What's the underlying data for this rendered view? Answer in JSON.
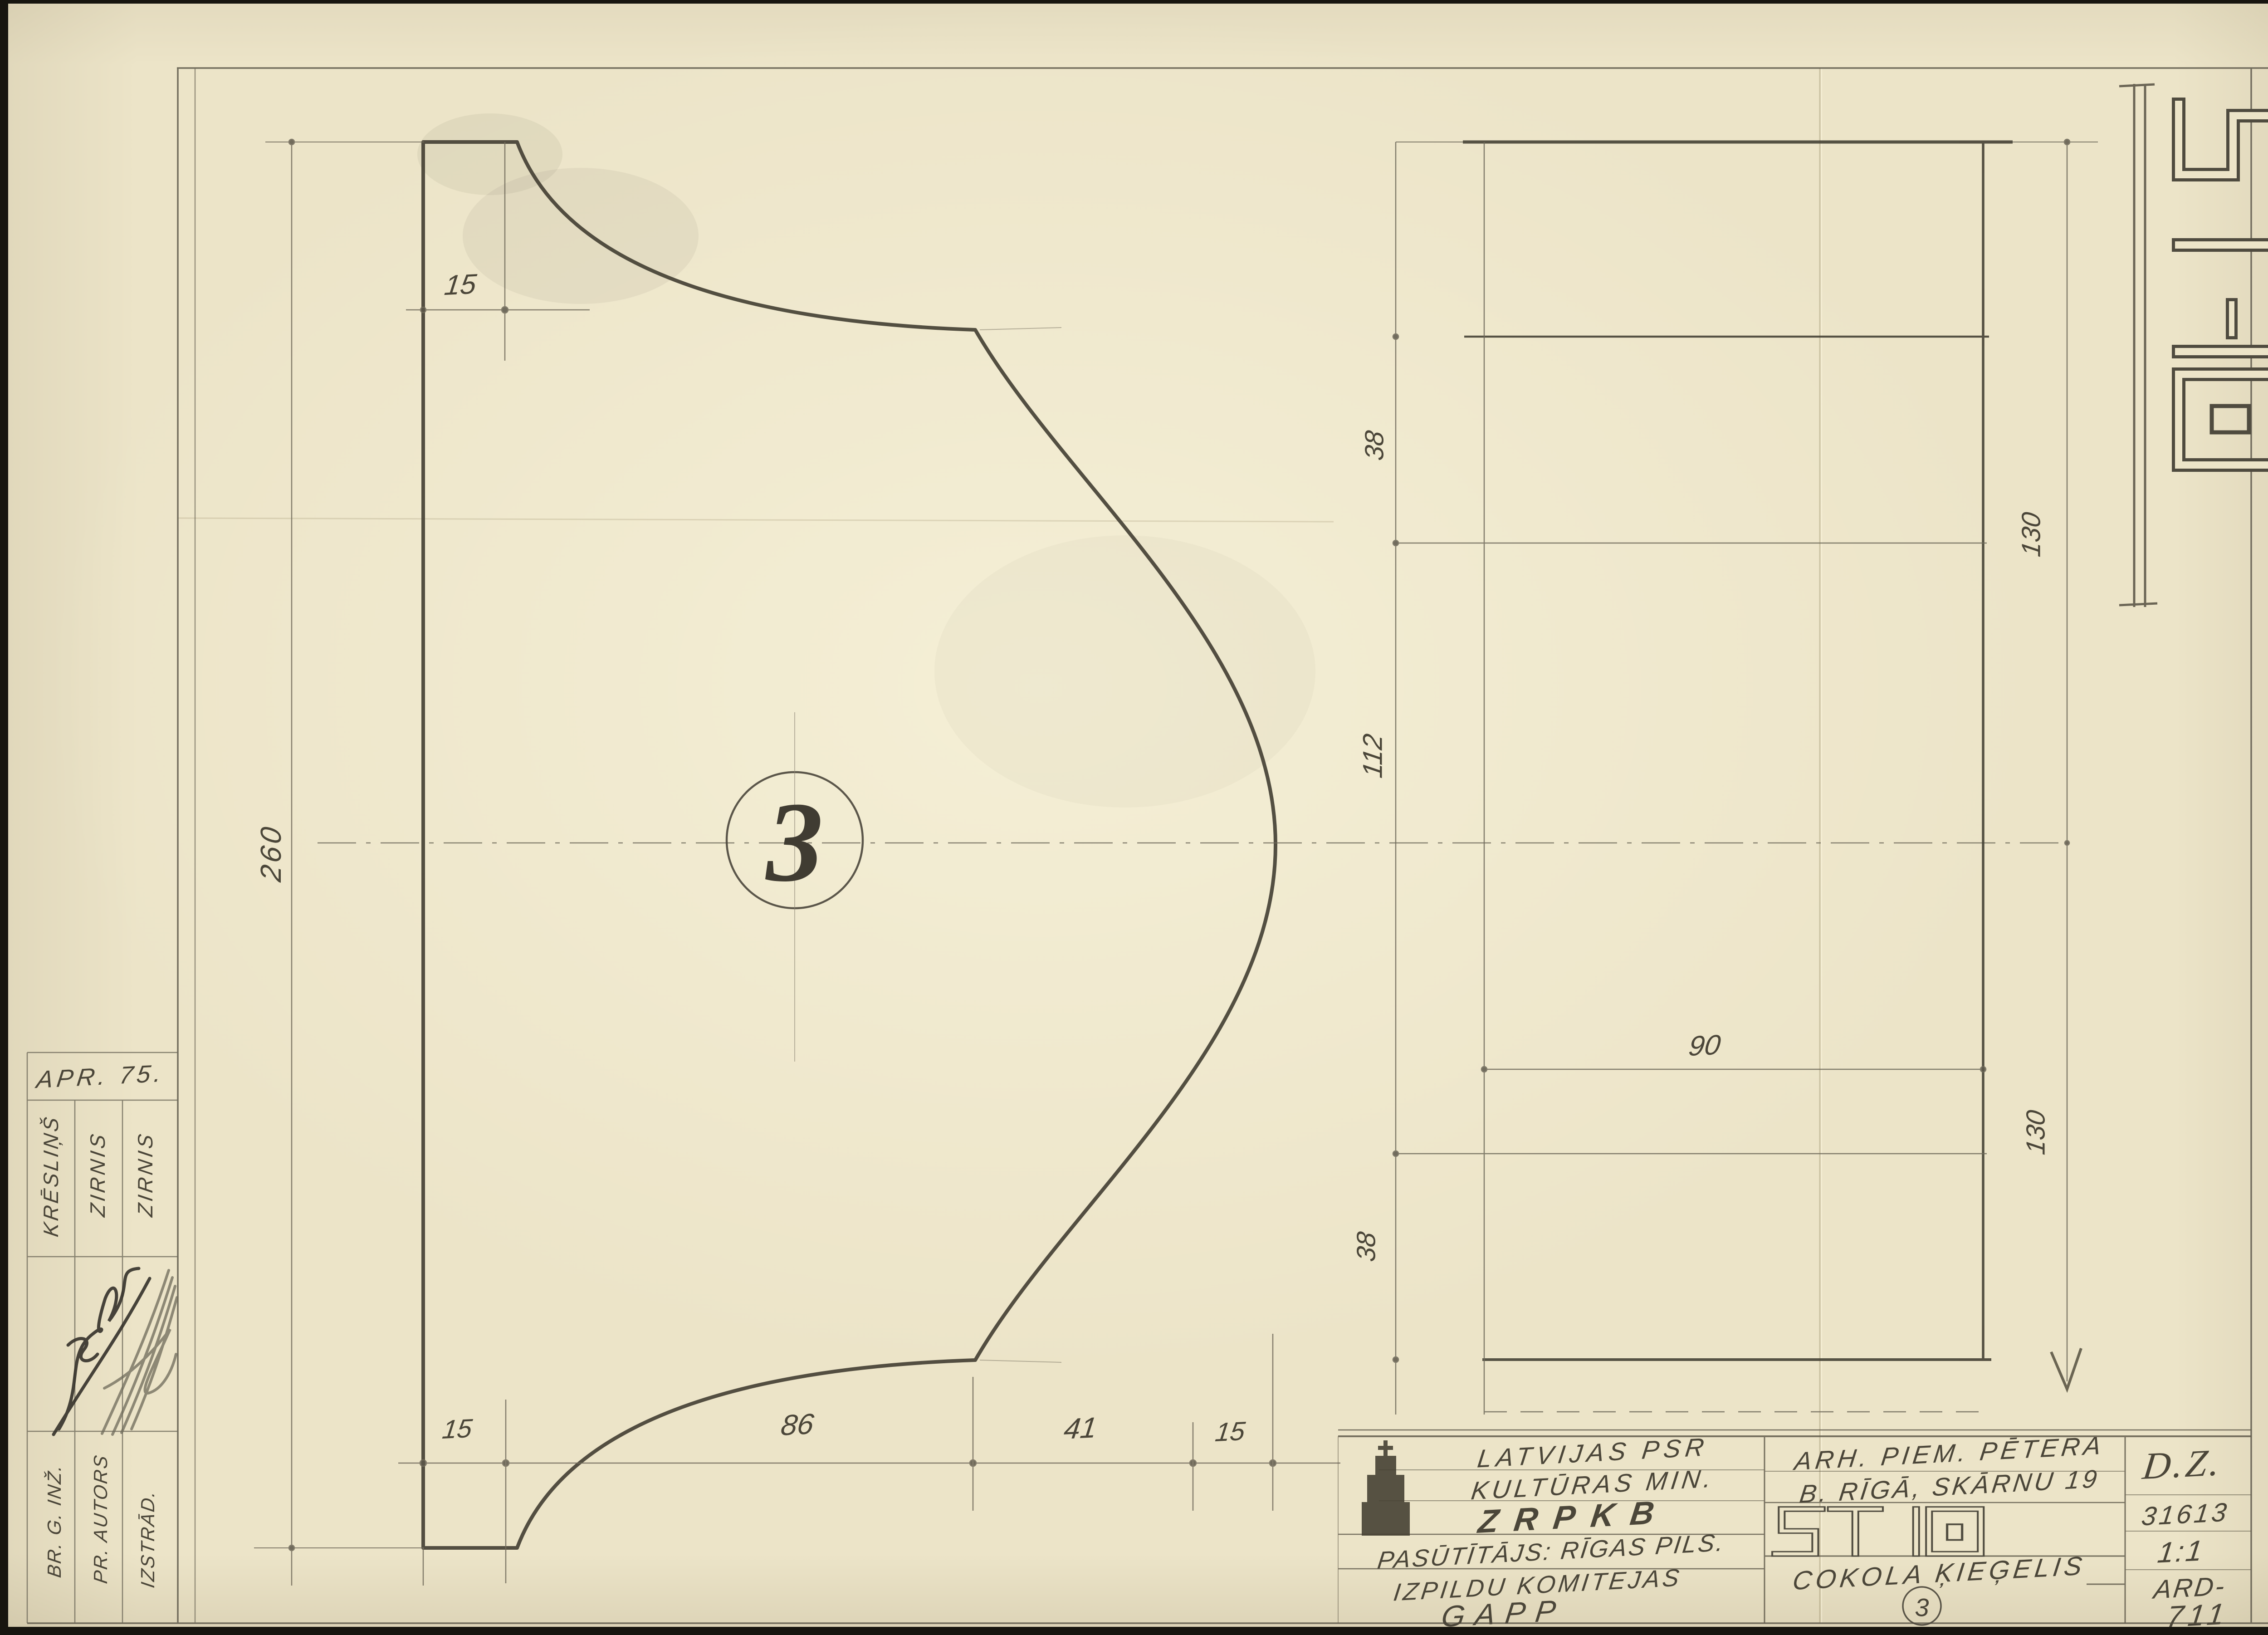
{
  "stamp": {
    "code": "ST-10"
  },
  "margin": {
    "approved": "APR. 75.",
    "columns": [
      {
        "role": "BR. G. INŽ.",
        "name": "KRĒSLIŅŠ"
      },
      {
        "role": "PR. AUTORS",
        "name": "ZIRNIS"
      },
      {
        "role": "IZSTRĀD.",
        "name": "ZIRNIS"
      }
    ]
  },
  "profile_view": {
    "balloon": "3",
    "dim_height": "260",
    "dim_top": "15",
    "dims_bottom": [
      "15",
      "86",
      "41",
      "15"
    ]
  },
  "plan_view": {
    "dims_left": [
      "38",
      "112",
      "38"
    ],
    "dims_right": [
      "130",
      "130"
    ],
    "dim_width": "90"
  },
  "title_block": {
    "org_line1": "LATVIJAS PSR",
    "org_line2": "KULTŪRAS MIN.",
    "org_line3": "ZRPKB",
    "client_line1": "PASŪTĪTĀJS: RĪGAS PILS.",
    "client_line2": "IZPILDU KOMITEJAS",
    "client_line3": "GAPP",
    "object_line1": "ARH. PIEM. PĒTERA",
    "object_line2": "B. RĪGĀ, SKĀRNU 19",
    "series": "ST 10",
    "part_name": "COKOLA ĶIEĢELIS",
    "part_no": "3",
    "code": "D.Z.",
    "doc_no": "31613",
    "scale": "1:1",
    "sheet_prefix": "ARD-",
    "sheet_no": "711"
  },
  "colors": {
    "paper": "#ece4c8",
    "pencil": "#4a463b"
  }
}
